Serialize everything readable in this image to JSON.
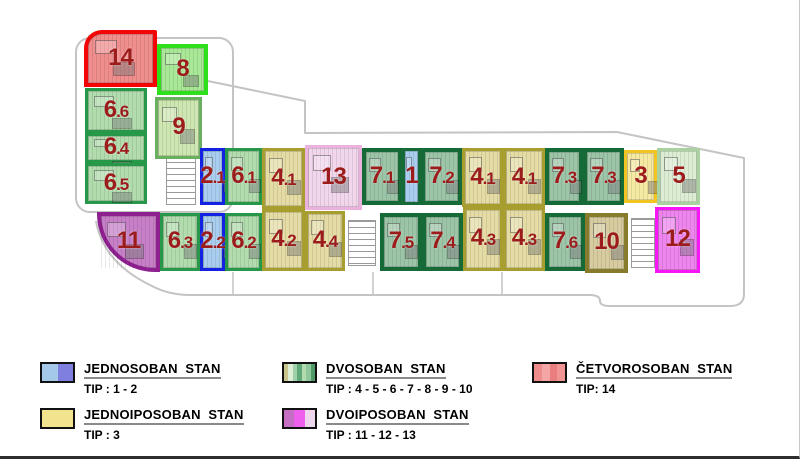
{
  "plan": {
    "outline_color": "#c4c4c4",
    "label_color": "#9c1b1b",
    "units": [
      {
        "id": "14",
        "label_main": "14",
        "label_suffix": "",
        "x": 84,
        "y": 30,
        "w": 73,
        "h": 57,
        "type": "cetvorosoban_14",
        "radius": "18px 2px 0 0"
      },
      {
        "id": "8",
        "label_main": "8",
        "label_suffix": "",
        "x": 157,
        "y": 44,
        "w": 51,
        "h": 51,
        "type": "dvosoban_8",
        "radius": ""
      },
      {
        "id": "9",
        "label_main": "9",
        "label_suffix": "",
        "x": 155,
        "y": 97,
        "w": 47,
        "h": 62,
        "type": "dvosoban_9",
        "radius": ""
      },
      {
        "id": "6.6",
        "label_main": "6",
        "label_suffix": ".6",
        "x": 85,
        "y": 88,
        "w": 62,
        "h": 45,
        "type": "dvosoban_6",
        "radius": ""
      },
      {
        "id": "6.4",
        "label_main": "6",
        "label_suffix": ".4",
        "x": 85,
        "y": 133,
        "w": 62,
        "h": 30,
        "type": "dvosoban_6",
        "radius": ""
      },
      {
        "id": "6.5",
        "label_main": "6",
        "label_suffix": ".5",
        "x": 85,
        "y": 163,
        "w": 62,
        "h": 41,
        "type": "dvosoban_6",
        "radius": ""
      },
      {
        "id": "2.1",
        "label_main": "2",
        "label_suffix": ".1",
        "x": 200,
        "y": 148,
        "w": 25,
        "h": 57,
        "type": "jednosoban_2",
        "radius": ""
      },
      {
        "id": "6.1",
        "label_main": "6",
        "label_suffix": ".1",
        "x": 225,
        "y": 148,
        "w": 37,
        "h": 57,
        "type": "dvosoban_6",
        "radius": ""
      },
      {
        "id": "4.1",
        "label_main": "4",
        "label_suffix": ".1",
        "x": 262,
        "y": 148,
        "w": 43,
        "h": 61,
        "type": "dvosoban_4",
        "radius": ""
      },
      {
        "id": "13",
        "label_main": "13",
        "label_suffix": "",
        "x": 305,
        "y": 145,
        "w": 57,
        "h": 65,
        "type": "dvoiposoban_13",
        "radius": ""
      },
      {
        "id": "7.1",
        "label_main": "7",
        "label_suffix": ".1",
        "x": 362,
        "y": 148,
        "w": 40,
        "h": 57,
        "type": "dvosoban_7",
        "radius": ""
      },
      {
        "id": "1",
        "label_main": "1",
        "label_suffix": "",
        "x": 402,
        "y": 148,
        "w": 19,
        "h": 57,
        "type": "jednosoban_1",
        "radius": ""
      },
      {
        "id": "7.2",
        "label_main": "7",
        "label_suffix": ".2",
        "x": 421,
        "y": 148,
        "w": 41,
        "h": 57,
        "type": "dvosoban_7",
        "radius": ""
      },
      {
        "id": "4.1",
        "label_main": "4",
        "label_suffix": ".1",
        "x": 462,
        "y": 148,
        "w": 41,
        "h": 59,
        "type": "dvosoban_4",
        "radius": ""
      },
      {
        "id": "4.1",
        "label_main": "4",
        "label_suffix": ".1",
        "x": 503,
        "y": 148,
        "w": 42,
        "h": 59,
        "type": "dvosoban_4",
        "radius": ""
      },
      {
        "id": "7.3",
        "label_main": "7",
        "label_suffix": ".3",
        "x": 545,
        "y": 148,
        "w": 38,
        "h": 57,
        "type": "dvosoban_7",
        "radius": ""
      },
      {
        "id": "7.3",
        "label_main": "7",
        "label_suffix": ".3",
        "x": 583,
        "y": 148,
        "w": 41,
        "h": 57,
        "type": "dvosoban_7",
        "radius": ""
      },
      {
        "id": "3",
        "label_main": "3",
        "label_suffix": "",
        "x": 624,
        "y": 150,
        "w": 33,
        "h": 53,
        "type": "jednoiposoban_3",
        "radius": ""
      },
      {
        "id": "5",
        "label_main": "5",
        "label_suffix": "",
        "x": 657,
        "y": 148,
        "w": 43,
        "h": 57,
        "type": "dvosoban_5",
        "radius": ""
      },
      {
        "id": "11",
        "label_main": "11",
        "label_suffix": "",
        "x": 97,
        "y": 212,
        "w": 63,
        "h": 60,
        "type": "dvoiposoban_11",
        "radius": "0 0 0 58px"
      },
      {
        "id": "6.3",
        "label_main": "6",
        "label_suffix": ".3",
        "x": 160,
        "y": 213,
        "w": 40,
        "h": 58,
        "type": "dvosoban_6",
        "radius": ""
      },
      {
        "id": "2.2",
        "label_main": "2",
        "label_suffix": ".2",
        "x": 200,
        "y": 213,
        "w": 25,
        "h": 58,
        "type": "jednosoban_2",
        "radius": ""
      },
      {
        "id": "6.2",
        "label_main": "6",
        "label_suffix": ".2",
        "x": 225,
        "y": 213,
        "w": 37,
        "h": 58,
        "type": "dvosoban_6",
        "radius": ""
      },
      {
        "id": "4.2",
        "label_main": "4",
        "label_suffix": ".2",
        "x": 262,
        "y": 209,
        "w": 43,
        "h": 62,
        "type": "dvosoban_4",
        "radius": ""
      },
      {
        "id": "4.4",
        "label_main": "4",
        "label_suffix": ".4",
        "x": 305,
        "y": 211,
        "w": 40,
        "h": 60,
        "type": "dvosoban_4",
        "radius": ""
      },
      {
        "id": "7.5",
        "label_main": "7",
        "label_suffix": ".5",
        "x": 380,
        "y": 213,
        "w": 42,
        "h": 58,
        "type": "dvosoban_7",
        "radius": ""
      },
      {
        "id": "7.4",
        "label_main": "7",
        "label_suffix": ".4",
        "x": 422,
        "y": 213,
        "w": 41,
        "h": 58,
        "type": "dvosoban_7",
        "radius": ""
      },
      {
        "id": "4.3",
        "label_main": "4",
        "label_suffix": ".3",
        "x": 463,
        "y": 207,
        "w": 40,
        "h": 64,
        "type": "dvosoban_4",
        "radius": ""
      },
      {
        "id": "4.3",
        "label_main": "4",
        "label_suffix": ".3",
        "x": 503,
        "y": 207,
        "w": 42,
        "h": 64,
        "type": "dvosoban_4",
        "radius": ""
      },
      {
        "id": "7.6",
        "label_main": "7",
        "label_suffix": ".6",
        "x": 545,
        "y": 213,
        "w": 40,
        "h": 58,
        "type": "dvosoban_7",
        "radius": ""
      },
      {
        "id": "10",
        "label_main": "10",
        "label_suffix": "",
        "x": 585,
        "y": 213,
        "w": 43,
        "h": 60,
        "type": "dvosoban_10",
        "radius": ""
      },
      {
        "id": "12",
        "label_main": "12",
        "label_suffix": "",
        "x": 655,
        "y": 207,
        "w": 45,
        "h": 66,
        "type": "dvoiposoban_12",
        "radius": ""
      }
    ],
    "palette": {
      "jednosoban_1": {
        "fill": "#a9cdee",
        "border": "#156a38",
        "bw": 3
      },
      "jednosoban_2": {
        "fill": "#a9cdee",
        "border": "#1322e2",
        "bw": 3
      },
      "jednoiposoban_3": {
        "fill": "#f6e9a2",
        "border": "#f3c522",
        "bw": 3
      },
      "dvosoban_4": {
        "fill": "#e4dca4",
        "border": "#a89d2f",
        "bw": 3
      },
      "dvosoban_5": {
        "fill": "#dcedd4",
        "border": "#a9d2a0",
        "bw": 3
      },
      "dvosoban_6": {
        "fill": "#b2dcae",
        "border": "#27984a",
        "bw": 3
      },
      "dvosoban_7": {
        "fill": "#9cc5a7",
        "border": "#156a38",
        "bw": 4
      },
      "dvosoban_8": {
        "fill": "#a8e896",
        "border": "#2ee01b",
        "bw": 4
      },
      "dvosoban_9": {
        "fill": "#cde6b2",
        "border": "#68b060",
        "bw": 3
      },
      "dvosoban_10": {
        "fill": "#d6cca0",
        "border": "#867c2c",
        "bw": 4
      },
      "dvoiposoban_11": {
        "fill": "#c780c7",
        "border": "#8e2090",
        "bw": 4
      },
      "dvoiposoban_12": {
        "fill": "#ee84ee",
        "border": "#f816f8",
        "bw": 3
      },
      "dvoiposoban_13": {
        "fill": "#f2d6ec",
        "border": "#eab2dd",
        "bw": 3
      },
      "cetvorosoban_14": {
        "fill": "#f08e8e",
        "border": "#f40505",
        "bw": 4
      }
    },
    "stairwells": [
      {
        "x": 166,
        "y": 149,
        "w": 30,
        "h": 56
      },
      {
        "x": 348,
        "y": 220,
        "w": 28,
        "h": 46
      },
      {
        "x": 631,
        "y": 218,
        "w": 24,
        "h": 50
      }
    ]
  },
  "legend": {
    "items": [
      {
        "slug": "jednosoban",
        "title": "JEDNOSOBAN  STAN",
        "tip": "TIP : 1 - 2",
        "x": 40,
        "y": 360,
        "swatch": [
          "#a3c8e8",
          "#7f7fdf"
        ]
      },
      {
        "slug": "jednoiposoban",
        "title": "JEDNOIPOSOBAN  STAN",
        "tip": "TIP : 3",
        "x": 40,
        "y": 406,
        "swatch": [
          "#f2e48e"
        ]
      },
      {
        "slug": "dvosoban",
        "title": "DVOSOBAN  STAN",
        "tip": "TIP : 4 - 5 - 6 - 7 - 8 - 9 - 10",
        "x": 282,
        "y": 360,
        "swatch": [
          "#c9c48c",
          "#ddeed6",
          "#9fd0a9",
          "#5fa878",
          "#b2dcae",
          "#8ec79b",
          "#4f9a68"
        ]
      },
      {
        "slug": "dvoiposoban",
        "title": "DVOIPOSOBAN  STAN",
        "tip": "TIP : 11 - 12 - 13",
        "x": 282,
        "y": 406,
        "swatch": [
          "#c46ec4",
          "#ee5fee",
          "#eed7ec"
        ]
      },
      {
        "slug": "cetvorosoban",
        "title": "ČETVOROSOBAN  STAN",
        "tip": "TIP: 14",
        "x": 532,
        "y": 360,
        "swatch": [
          "#ee8b8b",
          "#f4a6a6",
          "#e87e7e",
          "#f09494"
        ]
      }
    ]
  }
}
